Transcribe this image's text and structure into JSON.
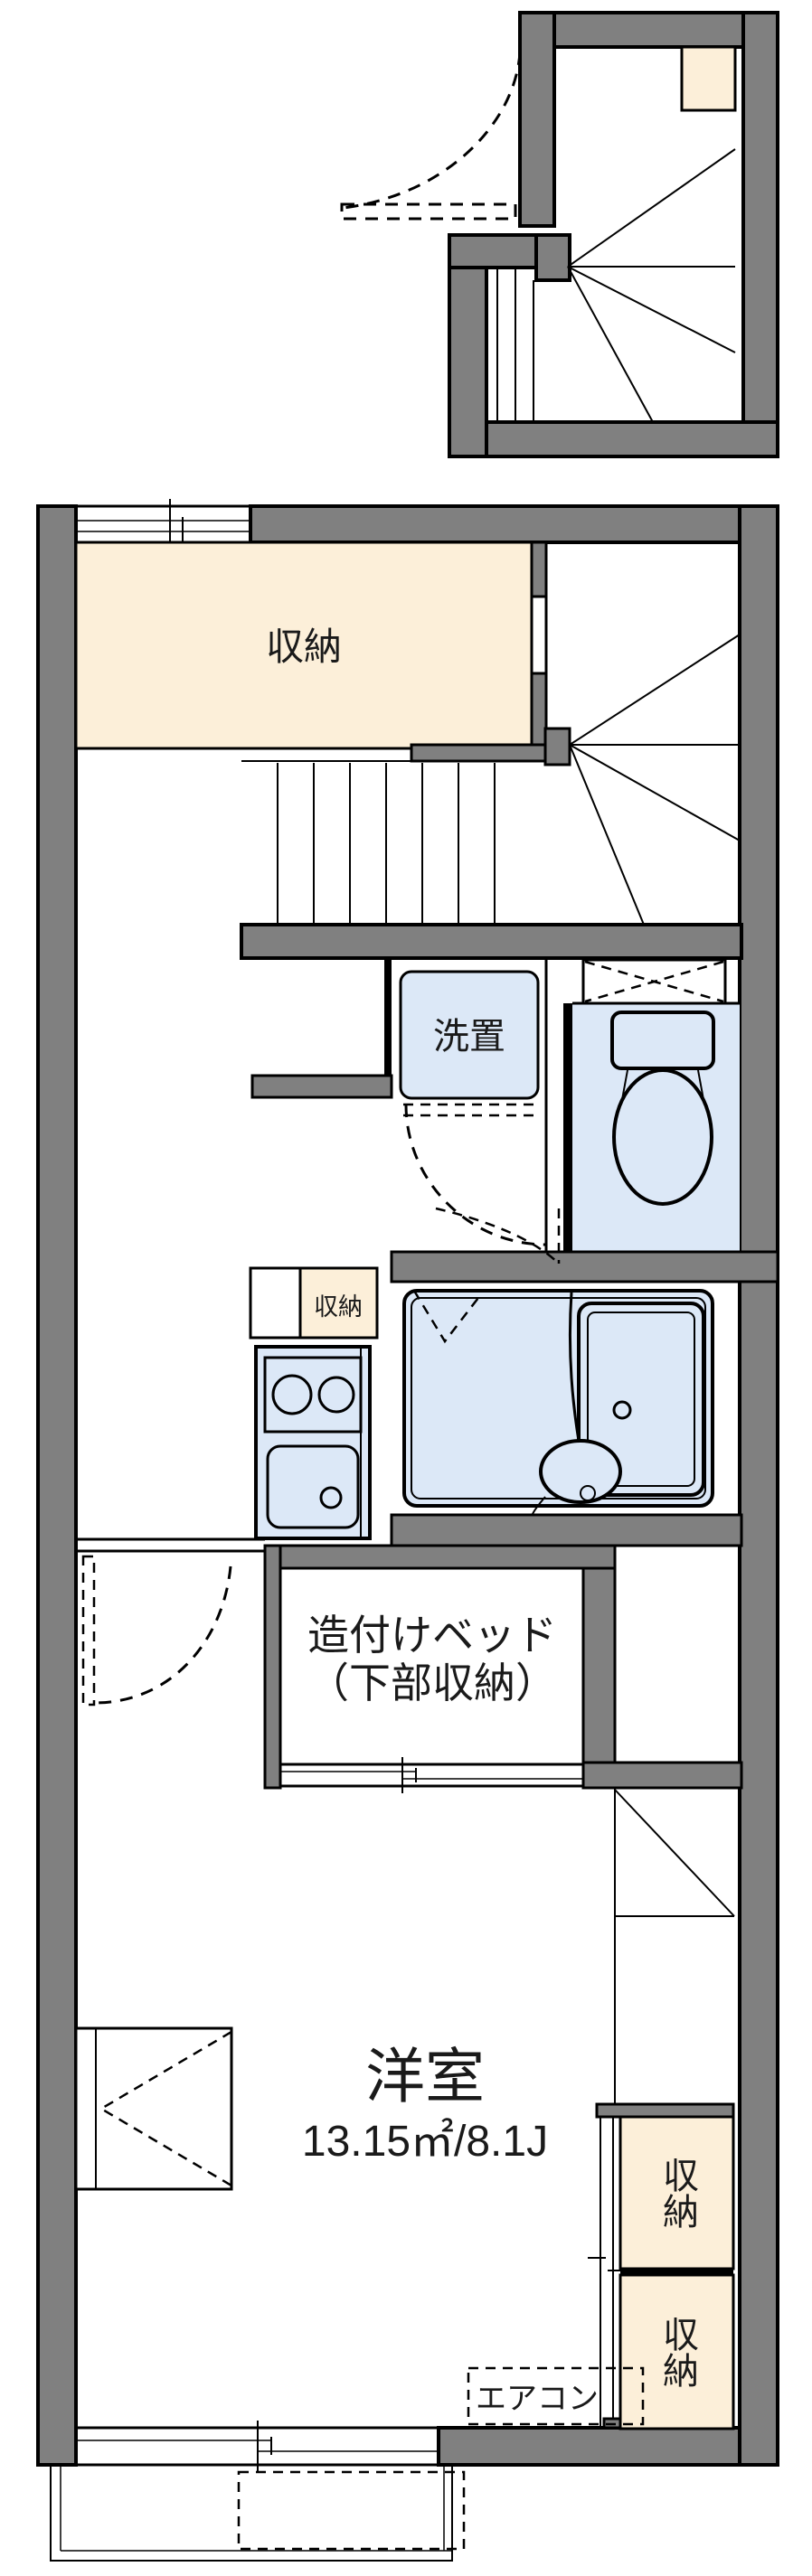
{
  "colors": {
    "wall_gray": "#808080",
    "storage_beige": "#fcefd9",
    "fixture_blue": "#dce8f7",
    "outline_black": "#000000"
  },
  "rooms": {
    "entrance_storage": {
      "label": "収納"
    },
    "washer_space": {
      "label": "洗置"
    },
    "kitchen_storage": {
      "label": "収納"
    },
    "built_in_bed": {
      "label_line1": "造付けベッド",
      "label_line2": "（下部収納）"
    },
    "western_room": {
      "name": "洋室",
      "area": "13.15㎡/8.1J"
    },
    "closet_upper": {
      "label": "収納"
    },
    "closet_lower": {
      "label": "収納"
    },
    "aircon": {
      "label": "エアコン"
    }
  }
}
